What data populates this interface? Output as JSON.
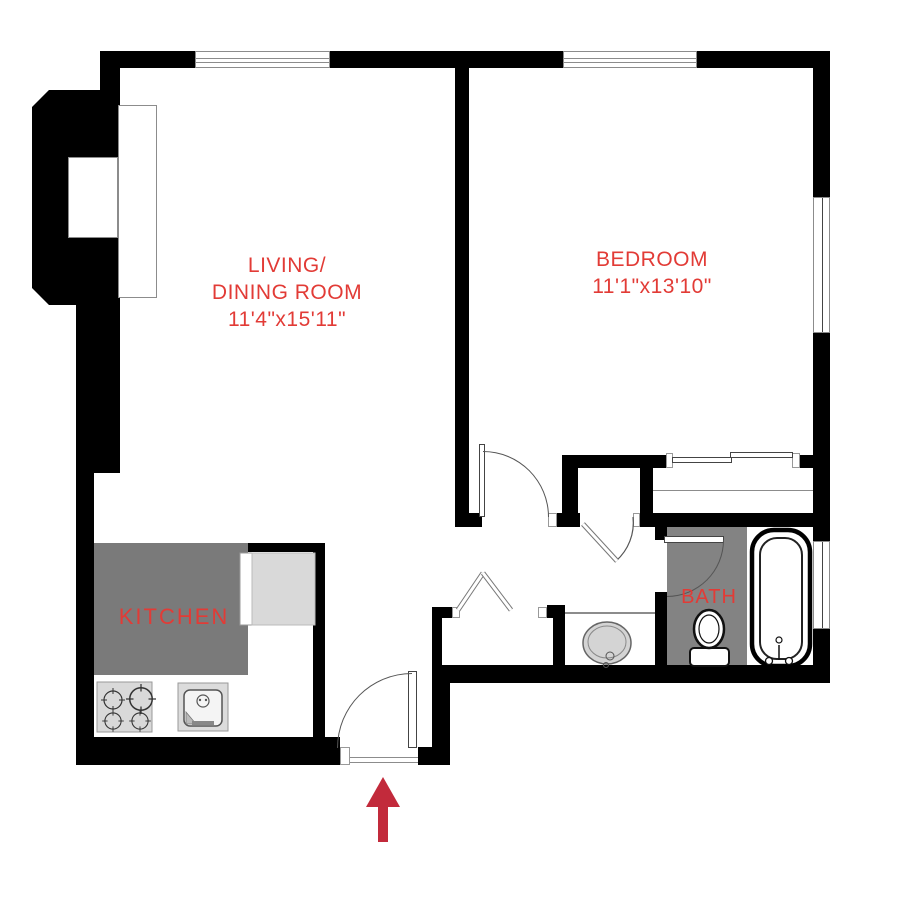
{
  "rooms": {
    "living_dining": {
      "label_line1": "LIVING/",
      "label_line2": "DINING ROOM",
      "dimensions": "11'4\"x15'11\""
    },
    "bedroom": {
      "label": "BEDROOM",
      "dimensions": "11'1\"x13'10\""
    },
    "kitchen": {
      "label": "KITCHEN"
    },
    "bath": {
      "label": "BATH"
    }
  },
  "fixtures": {
    "stove": "4-burner stove",
    "kitchen_sink": "kitchen sink",
    "refrigerator": "refrigerator/counter",
    "bathroom_sink": "vanity sink",
    "toilet": "toilet",
    "bathtub": "bathtub",
    "entry_arrow": "entrance arrow"
  },
  "colors": {
    "wall": "#000000",
    "label_red": "#e23b36",
    "arrow_red": "#c22a3b",
    "kitchen_floor": "#7a7a7a",
    "bath_floor": "#838383",
    "appliance_gray": "#d9d9d9",
    "line_gray": "#8c8c8c"
  }
}
